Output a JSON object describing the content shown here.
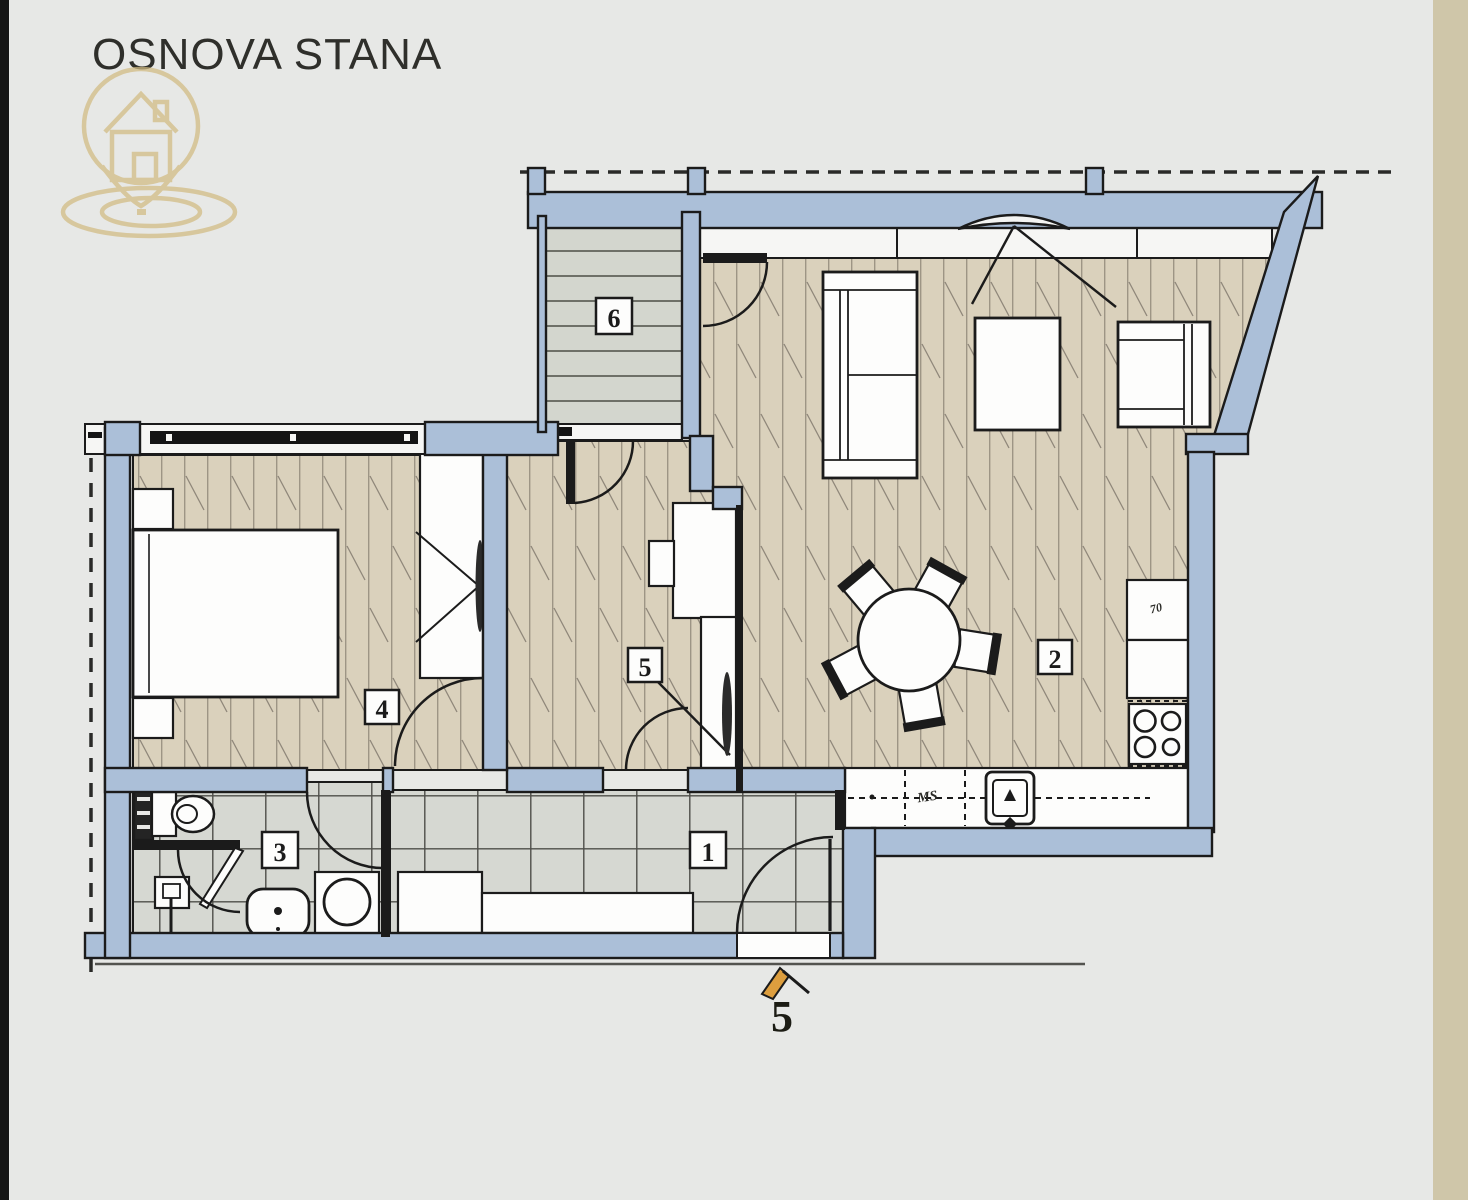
{
  "page": {
    "title": "OSNOVA STANA"
  },
  "rooms": [
    {
      "number": "1"
    },
    {
      "number": "2"
    },
    {
      "number": "3"
    },
    {
      "number": "4"
    },
    {
      "number": "5"
    },
    {
      "number": "6"
    }
  ],
  "annotations": {
    "dishwasher_label": "MS",
    "fridge_dim_label": "70",
    "entrance_number": "5"
  },
  "colors": {
    "wall": "#abbfd8",
    "outline": "#1b1b1b",
    "wood_floor": "#dad1bc",
    "deck_floor": "#d3d6ce",
    "tile_floor": "#d6d8d2",
    "page_bg": "#e7e8e6",
    "right_strip": "#cfc6a9",
    "logo_gold": "#d2bb82",
    "entrance_arrow": "#dd9e3e"
  }
}
